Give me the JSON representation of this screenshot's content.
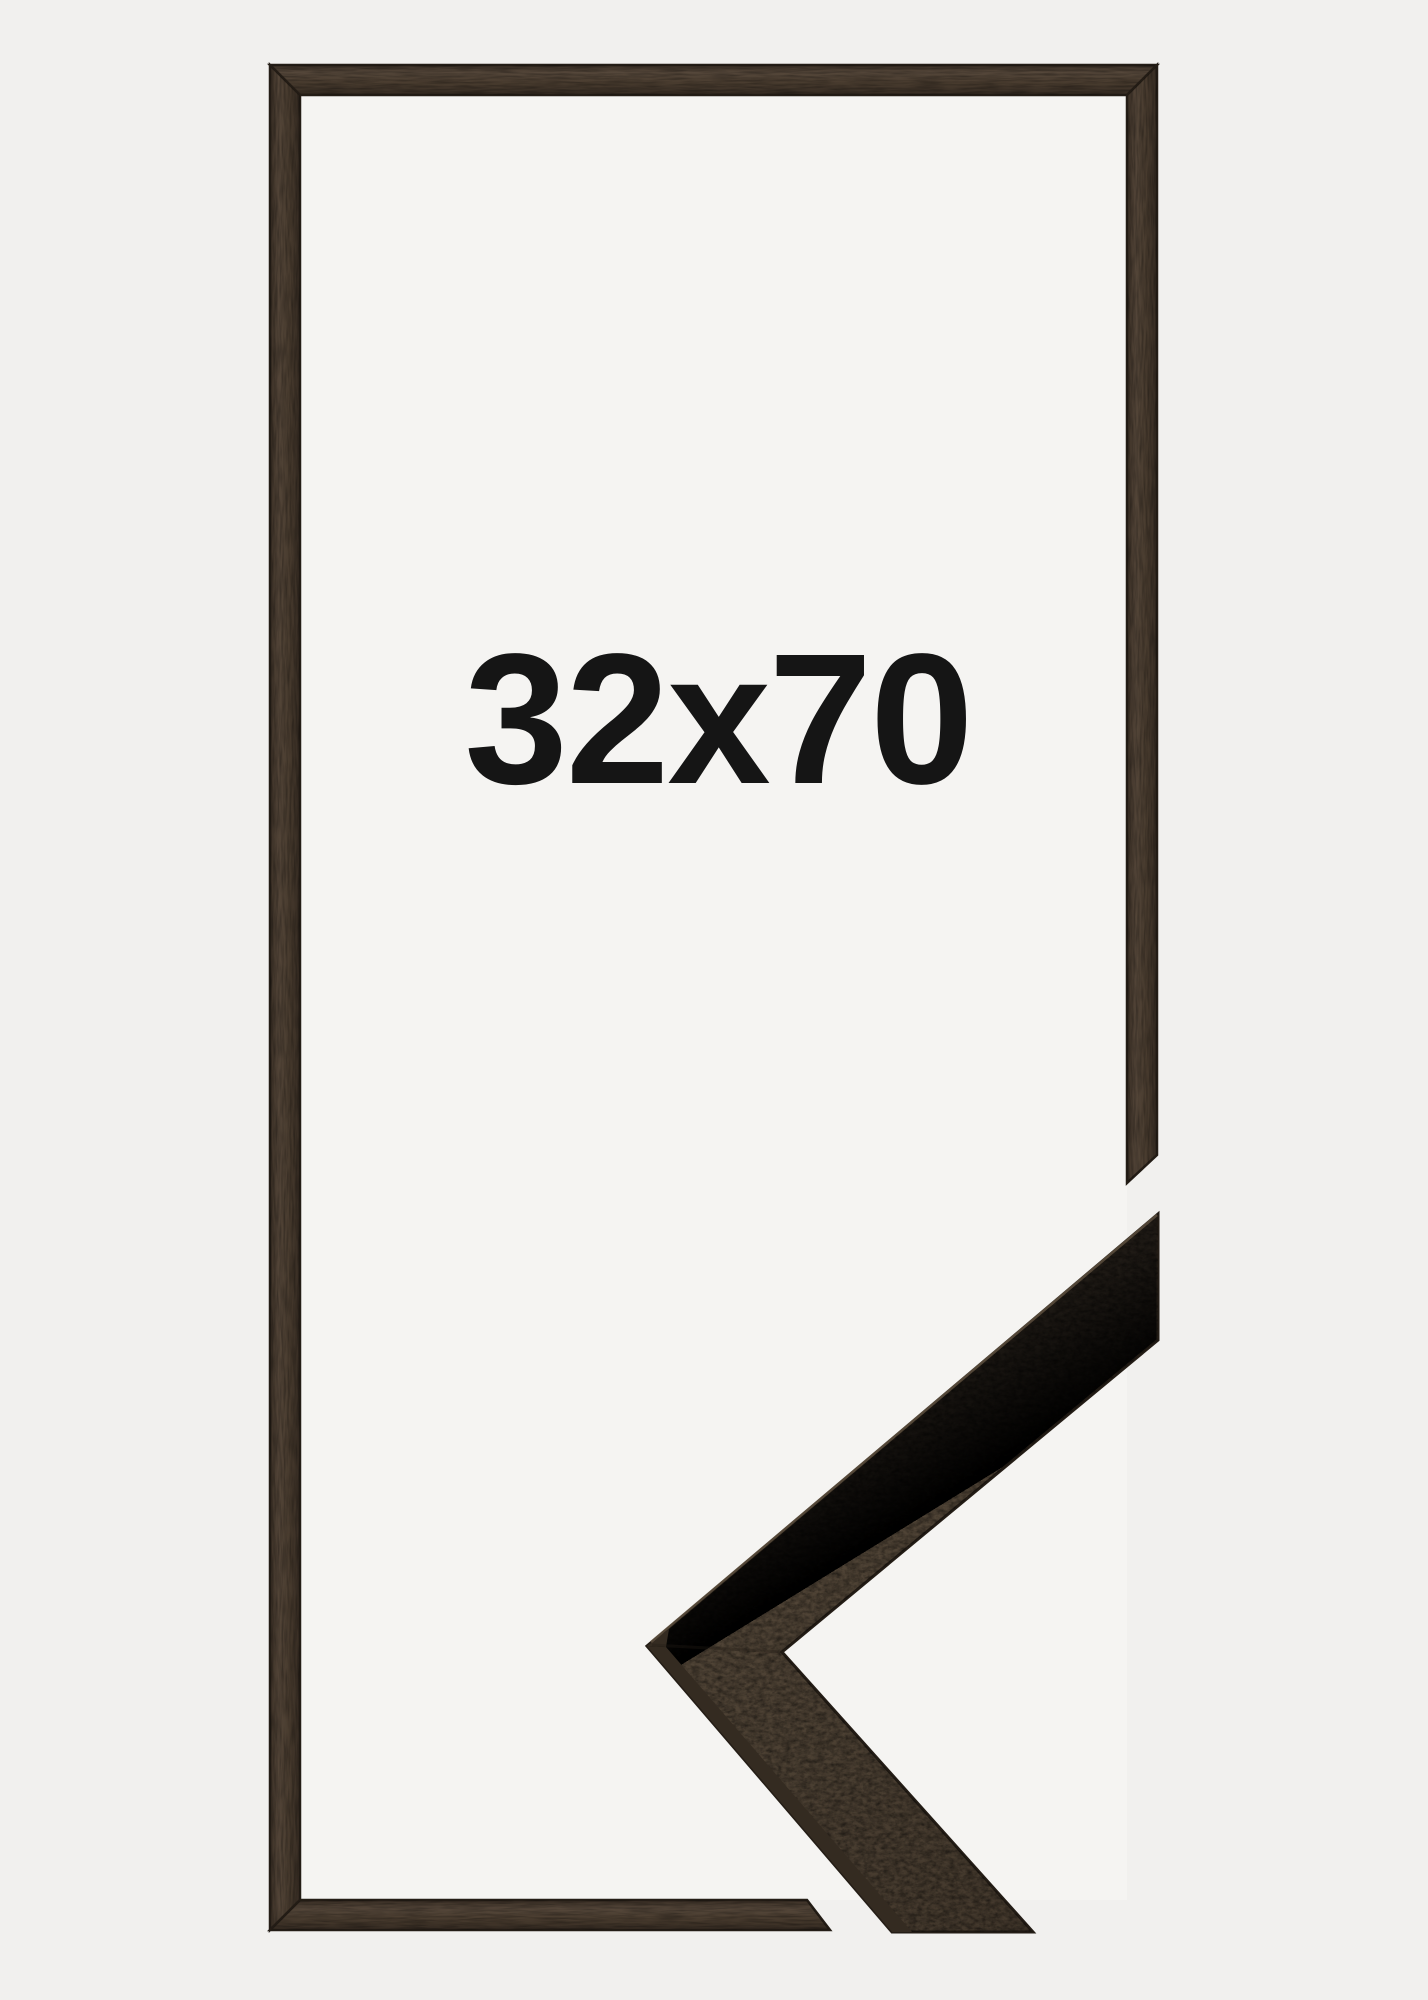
{
  "product": {
    "size_label": "32x70"
  },
  "colors": {
    "background": "#f1f0ee",
    "inner_area": "#f5f4f2",
    "wood_light": "#5d4f40",
    "wood_mid": "#4a3d30",
    "wood_dark": "#392e24",
    "wood_highlight": "#7d6c56",
    "edge_dark": "#241d16",
    "side_face": "#342b21",
    "label_text": "#151515"
  }
}
